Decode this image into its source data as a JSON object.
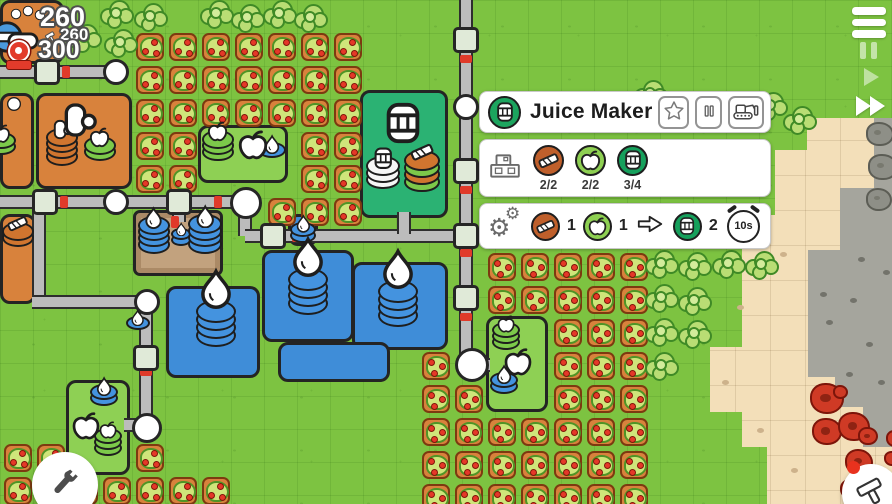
{
  "hud": {
    "main_count": "260",
    "build_count": "260",
    "score_count": "300"
  },
  "panel": {
    "title": "Juice Maker",
    "inventory": [
      {
        "item": "plank",
        "count": "2/2"
      },
      {
        "item": "apple",
        "count": "2/2"
      },
      {
        "item": "juice-barrel",
        "count": "3/4"
      }
    ],
    "recipe": {
      "inputs": [
        {
          "item": "plank",
          "qty": "1"
        },
        {
          "item": "apple",
          "qty": "1"
        }
      ],
      "output": {
        "item": "juice-barrel",
        "qty": "2"
      },
      "duration": "10s"
    }
  },
  "colors": {
    "grass": "#7dc341",
    "sand": "#f3dfb9",
    "stone": "#a5a59d",
    "water": "#3f8dd8",
    "orchard": "#d8823c",
    "juice_building": "#2bb273",
    "panel_icon_green": "#1ca45e",
    "item_orange": "#bf5f2b",
    "item_apple_green": "#8ed052",
    "item_juice_green": "#16a05c",
    "berry_red": "#cf3a25"
  },
  "map": {
    "sand_poly": "807,118 892,118 892,504 767,504 767,447 742,447 742,412 710,412 710,347 742,347 742,215 775,215 775,150 807,150",
    "stone_poly": "874,118 892,118 892,447 863,447 863,407 835,407 835,377 808,377 808,250 840,250 840,188 874,188",
    "orchards": [
      [
        136,
        33
      ],
      [
        169,
        33
      ],
      [
        202,
        33
      ],
      [
        235,
        33
      ],
      [
        268,
        33
      ],
      [
        301,
        33
      ],
      [
        334,
        33
      ],
      [
        136,
        66
      ],
      [
        169,
        66
      ],
      [
        202,
        66
      ],
      [
        235,
        66
      ],
      [
        268,
        66
      ],
      [
        301,
        66
      ],
      [
        334,
        66
      ],
      [
        136,
        99
      ],
      [
        169,
        99
      ],
      [
        202,
        99
      ],
      [
        235,
        99
      ],
      [
        268,
        99
      ],
      [
        301,
        99
      ],
      [
        334,
        99
      ],
      [
        136,
        132
      ],
      [
        169,
        132
      ],
      [
        301,
        132
      ],
      [
        334,
        132
      ],
      [
        136,
        165
      ],
      [
        169,
        165
      ],
      [
        301,
        165
      ],
      [
        334,
        165
      ],
      [
        268,
        198
      ],
      [
        301,
        198
      ],
      [
        334,
        198
      ],
      [
        488,
        253
      ],
      [
        521,
        253
      ],
      [
        554,
        253
      ],
      [
        587,
        253
      ],
      [
        620,
        253
      ],
      [
        488,
        286
      ],
      [
        521,
        286
      ],
      [
        554,
        286
      ],
      [
        587,
        286
      ],
      [
        620,
        286
      ],
      [
        554,
        319
      ],
      [
        587,
        319
      ],
      [
        620,
        319
      ],
      [
        422,
        352
      ],
      [
        554,
        352
      ],
      [
        587,
        352
      ],
      [
        620,
        352
      ],
      [
        422,
        385
      ],
      [
        455,
        385
      ],
      [
        554,
        385
      ],
      [
        587,
        385
      ],
      [
        620,
        385
      ],
      [
        422,
        418
      ],
      [
        455,
        418
      ],
      [
        488,
        418
      ],
      [
        521,
        418
      ],
      [
        554,
        418
      ],
      [
        587,
        418
      ],
      [
        620,
        418
      ],
      [
        422,
        451
      ],
      [
        455,
        451
      ],
      [
        488,
        451
      ],
      [
        521,
        451
      ],
      [
        554,
        451
      ],
      [
        587,
        451
      ],
      [
        620,
        451
      ],
      [
        422,
        484
      ],
      [
        455,
        484
      ],
      [
        488,
        484
      ],
      [
        521,
        484
      ],
      [
        554,
        484
      ],
      [
        587,
        484
      ],
      [
        620,
        484
      ],
      [
        4,
        444
      ],
      [
        37,
        444
      ],
      [
        136,
        444
      ],
      [
        4,
        477
      ],
      [
        37,
        477
      ],
      [
        70,
        477
      ],
      [
        103,
        477
      ],
      [
        136,
        477
      ],
      [
        169,
        477
      ],
      [
        202,
        477
      ]
    ],
    "trees": [
      [
        100,
        0
      ],
      [
        134,
        3
      ],
      [
        200,
        0
      ],
      [
        231,
        4
      ],
      [
        263,
        0
      ],
      [
        294,
        4
      ],
      [
        68,
        24
      ],
      [
        104,
        29
      ],
      [
        634,
        80
      ],
      [
        664,
        92
      ],
      [
        754,
        92
      ],
      [
        783,
        106
      ],
      [
        645,
        250
      ],
      [
        678,
        252
      ],
      [
        712,
        250
      ],
      [
        745,
        251
      ],
      [
        645,
        284
      ],
      [
        678,
        287
      ],
      [
        645,
        318
      ],
      [
        678,
        320
      ],
      [
        645,
        352
      ]
    ],
    "plots": [
      {
        "t": "orange",
        "x": 0,
        "y": 0,
        "w": 64,
        "h": 64,
        "n": "farm-plot"
      },
      {
        "t": "orange",
        "x": 0,
        "y": 93,
        "w": 34,
        "h": 96,
        "n": "farm-plot"
      },
      {
        "t": "orange",
        "x": 36,
        "y": 93,
        "w": 96,
        "h": 96,
        "n": "farm-plot"
      },
      {
        "t": "orange",
        "x": 0,
        "y": 214,
        "w": 36,
        "h": 90,
        "n": "farm-plot"
      },
      {
        "t": "green",
        "x": 198,
        "y": 125,
        "w": 90,
        "h": 58,
        "n": "collector-plot"
      },
      {
        "t": "juice",
        "x": 360,
        "y": 90,
        "w": 88,
        "h": 128,
        "n": "juice-maker-building"
      },
      {
        "t": "green",
        "x": 486,
        "y": 316,
        "w": 62,
        "h": 96,
        "n": "collector-plot"
      },
      {
        "t": "green",
        "x": 66,
        "y": 380,
        "w": 64,
        "h": 95,
        "n": "collector-plot"
      },
      {
        "t": "well",
        "x": 133,
        "y": 210,
        "w": 90,
        "h": 66,
        "n": "well"
      },
      {
        "t": "water",
        "x": 166,
        "y": 286,
        "w": 94,
        "h": 92,
        "n": "water-plot"
      },
      {
        "t": "water",
        "x": 262,
        "y": 250,
        "w": 92,
        "h": 92,
        "n": "water-plot"
      },
      {
        "t": "water",
        "x": 352,
        "y": 262,
        "w": 96,
        "h": 88,
        "n": "water-plot"
      },
      {
        "t": "water",
        "x": 278,
        "y": 342,
        "w": 112,
        "h": 40,
        "n": "water-plot"
      },
      {
        "t": "water",
        "x": 288,
        "y": 214,
        "w": 30,
        "h": 32,
        "n": "water-plot"
      }
    ],
    "pipes": [
      [
        "h",
        0,
        65,
        116
      ],
      [
        "h",
        0,
        195,
        240
      ],
      [
        "v",
        238,
        205,
        31
      ],
      [
        "h",
        245,
        229,
        228
      ],
      [
        "v",
        459,
        0,
        360
      ],
      [
        "v",
        32,
        205,
        100
      ],
      [
        "h",
        32,
        295,
        112
      ],
      [
        "v",
        139,
        295,
        128
      ],
      [
        "v",
        397,
        212,
        22
      ],
      [
        "v",
        172,
        206,
        16
      ],
      [
        "h",
        474,
        358,
        16
      ],
      [
        "h",
        124,
        418,
        12
      ]
    ],
    "junctions": [
      [
        34,
        59
      ],
      [
        32,
        189
      ],
      [
        166,
        189
      ],
      [
        453,
        27
      ],
      [
        453,
        158
      ],
      [
        453,
        223
      ],
      [
        453,
        285
      ],
      [
        260,
        223
      ],
      [
        133,
        345
      ]
    ],
    "nodes": [
      [
        103,
        59,
        26
      ],
      [
        103,
        189,
        26
      ],
      [
        230,
        187,
        32
      ],
      [
        453,
        94,
        26
      ],
      [
        455,
        348,
        34
      ],
      [
        134,
        289,
        26
      ],
      [
        132,
        413,
        30
      ]
    ],
    "ticks": [
      [
        "h",
        62,
        66
      ],
      [
        "h",
        60,
        196
      ],
      [
        "h",
        214,
        196
      ],
      [
        "h",
        292,
        230
      ],
      [
        "v",
        460,
        55
      ],
      [
        "v",
        460,
        186
      ],
      [
        "v",
        460,
        249
      ],
      [
        "v",
        460,
        313
      ],
      [
        "v",
        140,
        368
      ],
      [
        "h",
        171,
        216
      ]
    ],
    "stacks": [
      {
        "x": 138,
        "y": 216,
        "n": 4,
        "d": 32,
        "c": "blue",
        "i": "drop"
      },
      {
        "x": 171,
        "y": 228,
        "n": 2,
        "d": 20,
        "c": "blue",
        "i": "drop"
      },
      {
        "x": 188,
        "y": 214,
        "n": 4,
        "d": 34,
        "c": "blue",
        "i": "drop"
      },
      {
        "x": 196,
        "y": 300,
        "n": 4,
        "d": 40,
        "c": "blue",
        "i": "drop",
        "big": 1
      },
      {
        "x": 288,
        "y": 268,
        "n": 4,
        "d": 40,
        "c": "blue",
        "i": "drop",
        "big": 1
      },
      {
        "x": 378,
        "y": 280,
        "n": 4,
        "d": 40,
        "c": "blue",
        "i": "drop",
        "big": 1
      },
      {
        "x": 290,
        "y": 222,
        "n": 2,
        "d": 26,
        "c": "blue",
        "i": "drop"
      },
      {
        "x": 126,
        "y": 316,
        "n": 1,
        "d": 24,
        "c": "blue",
        "i": "drop"
      },
      {
        "x": 46,
        "y": 128,
        "n": 4,
        "d": 32,
        "c": "orange",
        "i": "hand"
      },
      {
        "x": 84,
        "y": 136,
        "n": 2,
        "d": 32,
        "c": "green",
        "i": "apple"
      },
      {
        "x": -14,
        "y": 132,
        "n": 2,
        "d": 30,
        "c": "green",
        "i": "apple"
      },
      {
        "x": 2,
        "y": 222,
        "n": 2,
        "d": 32,
        "c": "orange",
        "i": "plank"
      },
      {
        "x": 202,
        "y": 130,
        "n": 3,
        "d": 32,
        "c": "green",
        "i": "apple"
      },
      {
        "x": 258,
        "y": 142,
        "n": 1,
        "d": 28,
        "c": "blue",
        "i": "drop"
      },
      {
        "x": 366,
        "y": 156,
        "n": 3,
        "d": 34,
        "c": "white",
        "i": "barrel"
      },
      {
        "x": 404,
        "y": 150,
        "n": 4,
        "d": 36,
        "c": "alt",
        "i": "plank"
      },
      {
        "x": 492,
        "y": 322,
        "n": 3,
        "d": 28,
        "c": "green",
        "i": "apple"
      },
      {
        "x": 490,
        "y": 372,
        "n": 2,
        "d": 28,
        "c": "blue",
        "i": "drop"
      },
      {
        "x": 90,
        "y": 384,
        "n": 2,
        "d": 28,
        "c": "blue",
        "i": "drop"
      },
      {
        "x": 94,
        "y": 428,
        "n": 3,
        "d": 28,
        "c": "green",
        "i": "apple"
      }
    ],
    "icons": [
      {
        "x": 236,
        "y": 128,
        "t": "apple",
        "s": 34
      },
      {
        "x": 502,
        "y": 346,
        "t": "apple",
        "s": 32
      },
      {
        "x": 70,
        "y": 410,
        "t": "apple",
        "s": 32
      },
      {
        "x": 380,
        "y": 100,
        "t": "barrel",
        "s": 46
      },
      {
        "x": 58,
        "y": 100,
        "t": "hand",
        "s": 40
      },
      {
        "x": 6,
        "y": 96,
        "t": "ball",
        "s": 16
      },
      {
        "x": 10,
        "y": 8,
        "t": "ball",
        "s": 12
      },
      {
        "x": 22,
        "y": 5,
        "t": "ball",
        "s": 12
      },
      {
        "x": 34,
        "y": 9,
        "t": "ball",
        "s": 12
      },
      {
        "x": -10,
        "y": 20,
        "t": "machine",
        "s": 34
      },
      {
        "x": 6,
        "y": 24,
        "t": "bar",
        "s": 34
      }
    ],
    "berries": [
      [
        810,
        383,
        30
      ],
      [
        833,
        385,
        11
      ],
      [
        812,
        418,
        26
      ],
      [
        838,
        412,
        28
      ],
      [
        858,
        427,
        16
      ],
      [
        845,
        449,
        24
      ],
      [
        862,
        466,
        26
      ],
      [
        840,
        479,
        18
      ],
      [
        877,
        489,
        22
      ],
      [
        856,
        492,
        16
      ],
      [
        884,
        451,
        12
      ],
      [
        886,
        430,
        14
      ]
    ],
    "rocks": [
      [
        866,
        122,
        24
      ],
      [
        868,
        154,
        26
      ],
      [
        866,
        188,
        22
      ]
    ],
    "pebbles_gray": [
      [
        826,
        320
      ],
      [
        850,
        298
      ],
      [
        866,
        342
      ],
      [
        820,
        292
      ],
      [
        846,
        372
      ],
      [
        878,
        380
      ],
      [
        858,
        257
      ],
      [
        883,
        270
      ]
    ],
    "pebbles_sand": [
      [
        737,
        305
      ],
      [
        757,
        428
      ],
      [
        791,
        468
      ],
      [
        722,
        380
      ],
      [
        780,
        252
      ]
    ]
  }
}
